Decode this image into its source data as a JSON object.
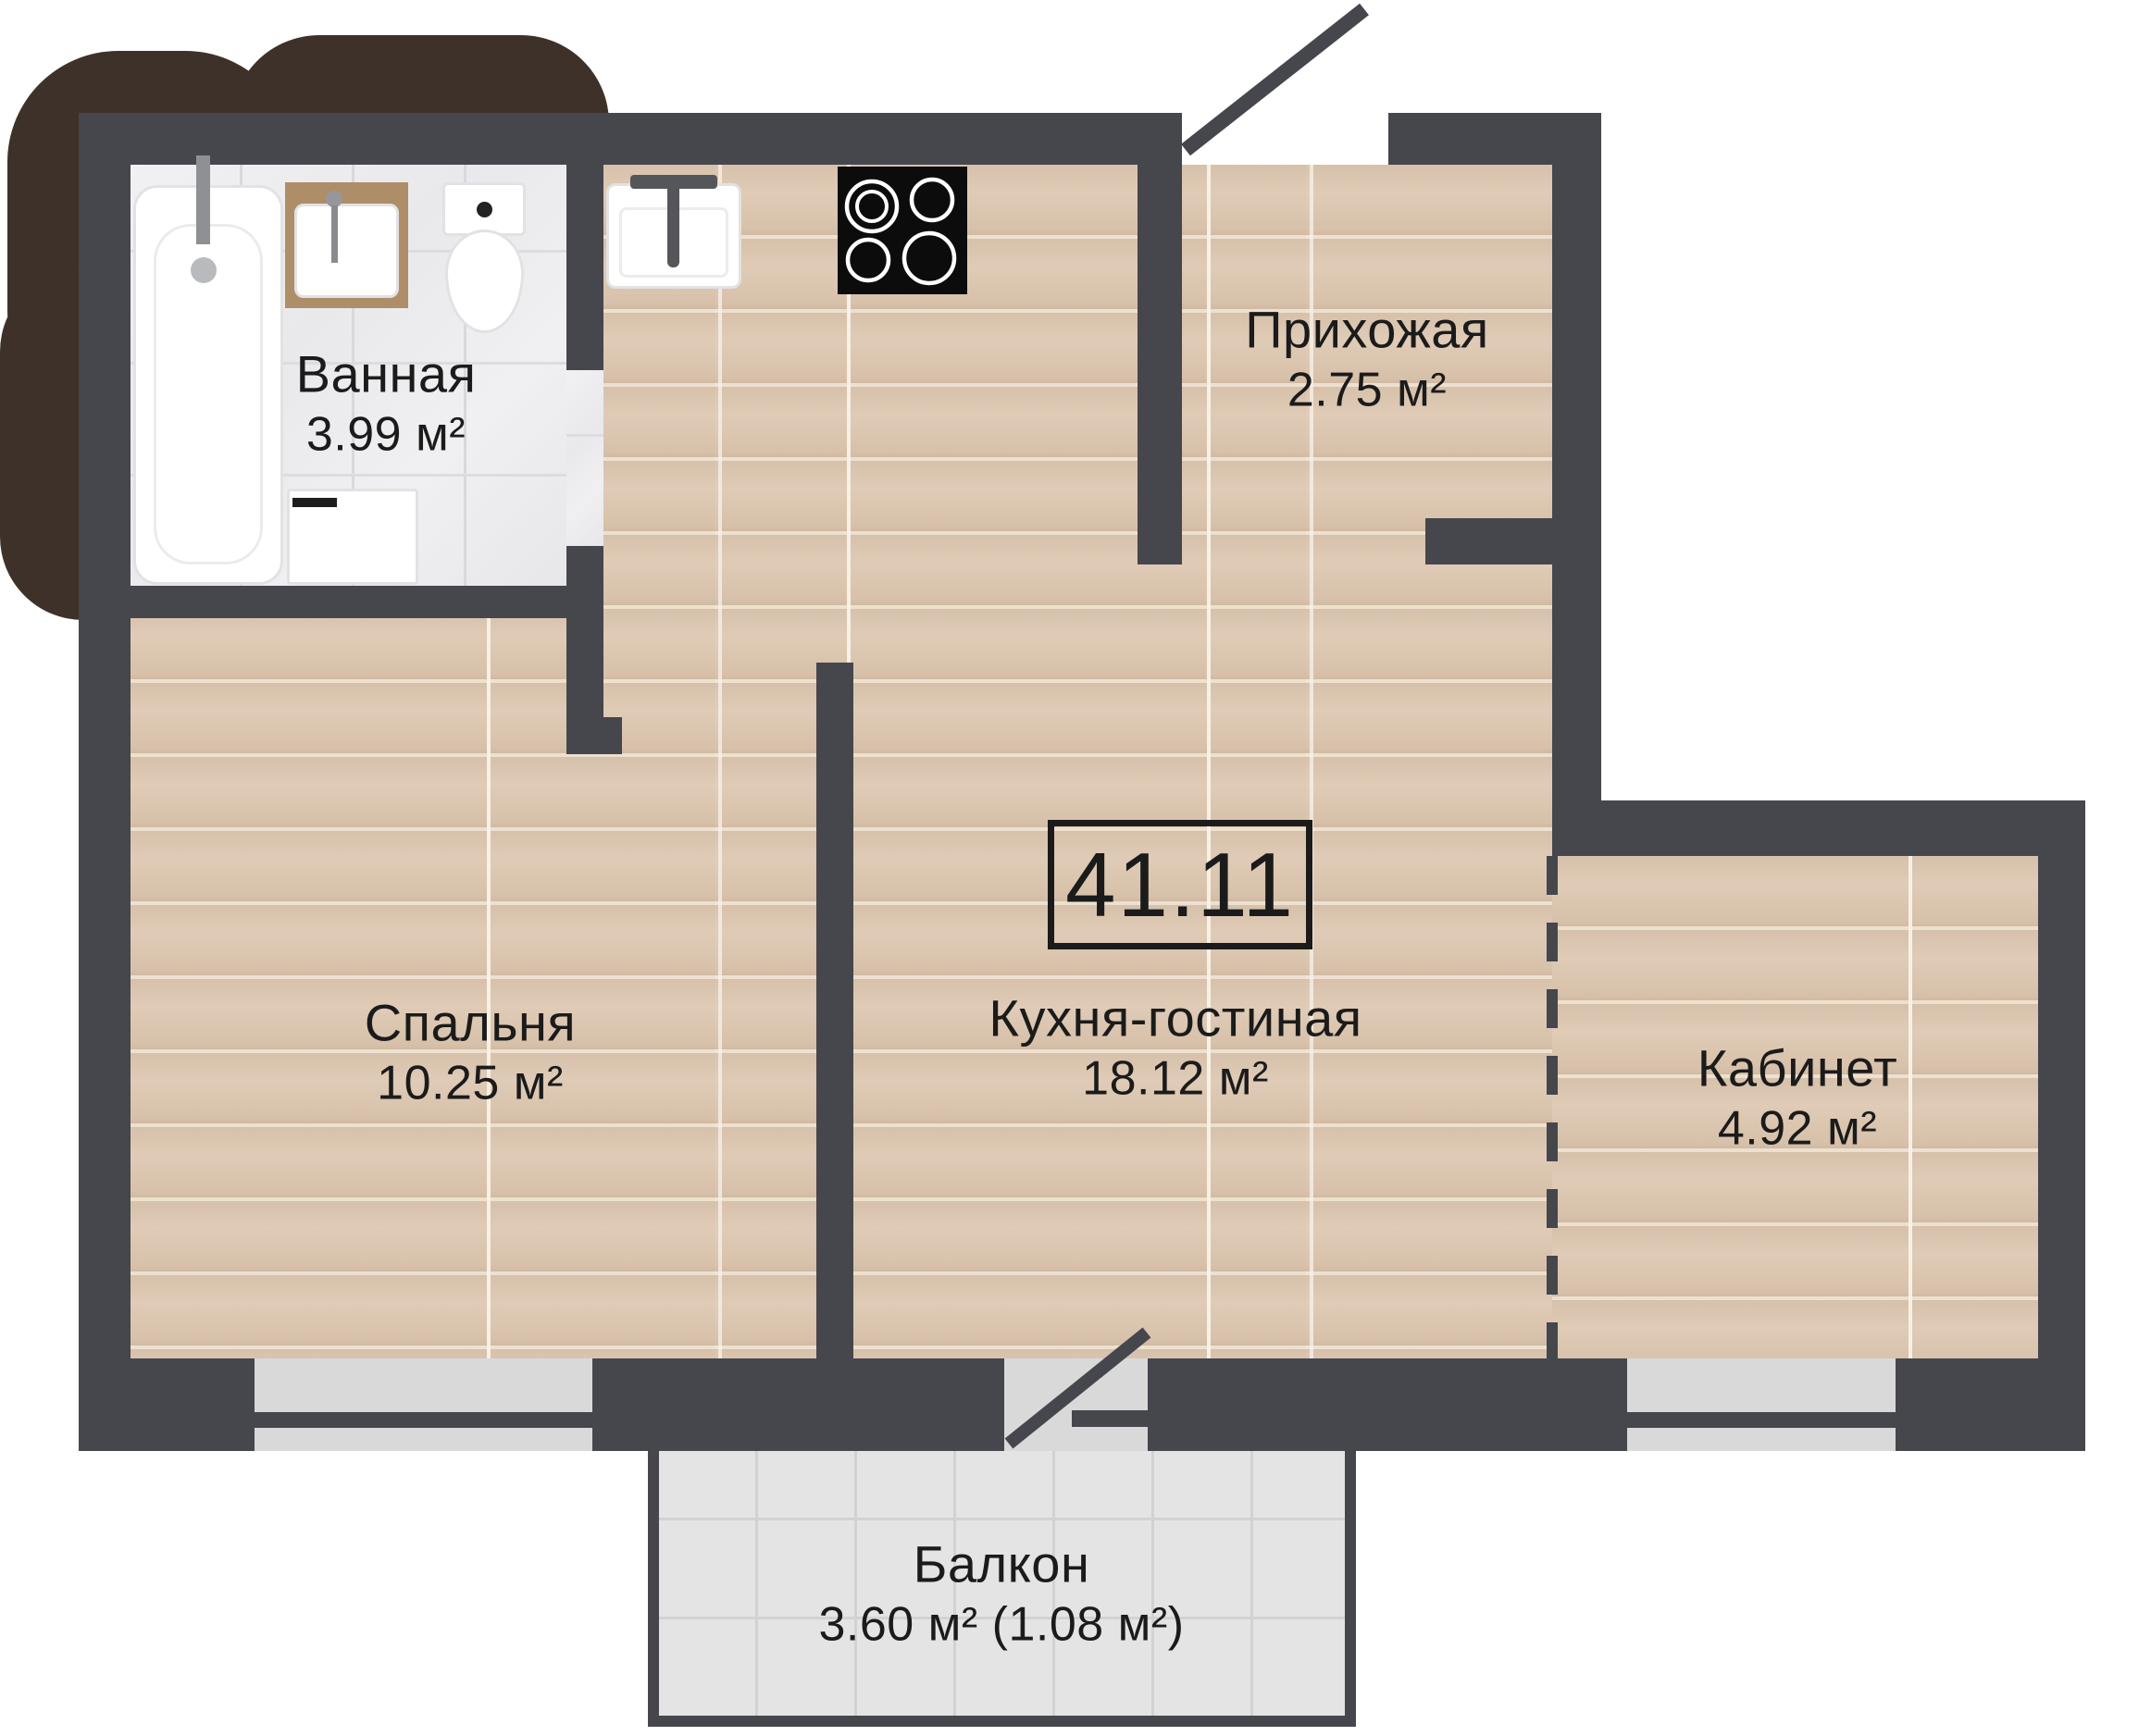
{
  "plan": {
    "type": "apartment-floor-plan",
    "total_area_label": "41.11",
    "rooms": [
      {
        "id": "bathroom",
        "name": "Ванная",
        "area": "3.99 м²"
      },
      {
        "id": "hallway",
        "name": "Прихожая",
        "area": "2.75 м²"
      },
      {
        "id": "kitchen_living",
        "name": "Кухня-гостиная",
        "area": "18.12 м²"
      },
      {
        "id": "bedroom",
        "name": "Спальня",
        "area": "10.25 м²"
      },
      {
        "id": "office",
        "name": "Кабинет",
        "area": "4.92 м²"
      },
      {
        "id": "balcony",
        "name": "Балкон",
        "area": "3.60 м² (1.08 м²)"
      }
    ],
    "fixtures": [
      "bathtub",
      "bathroom-sink",
      "toilet",
      "washing-machine",
      "kitchen-sink",
      "stove",
      "entrance-door",
      "balcony-door"
    ],
    "colors": {
      "wall": "#46464D",
      "wood_floor": "#DCC8B4",
      "bathroom_tile": "#EDEDEF",
      "balcony_tile": "#E4E4E4",
      "window_pane": "#D9D9D9",
      "background_blob": "#3E3129",
      "text": "#1B1B1B",
      "stove": "#0C0C0C",
      "vanity_wood": "#AE8E68"
    }
  }
}
